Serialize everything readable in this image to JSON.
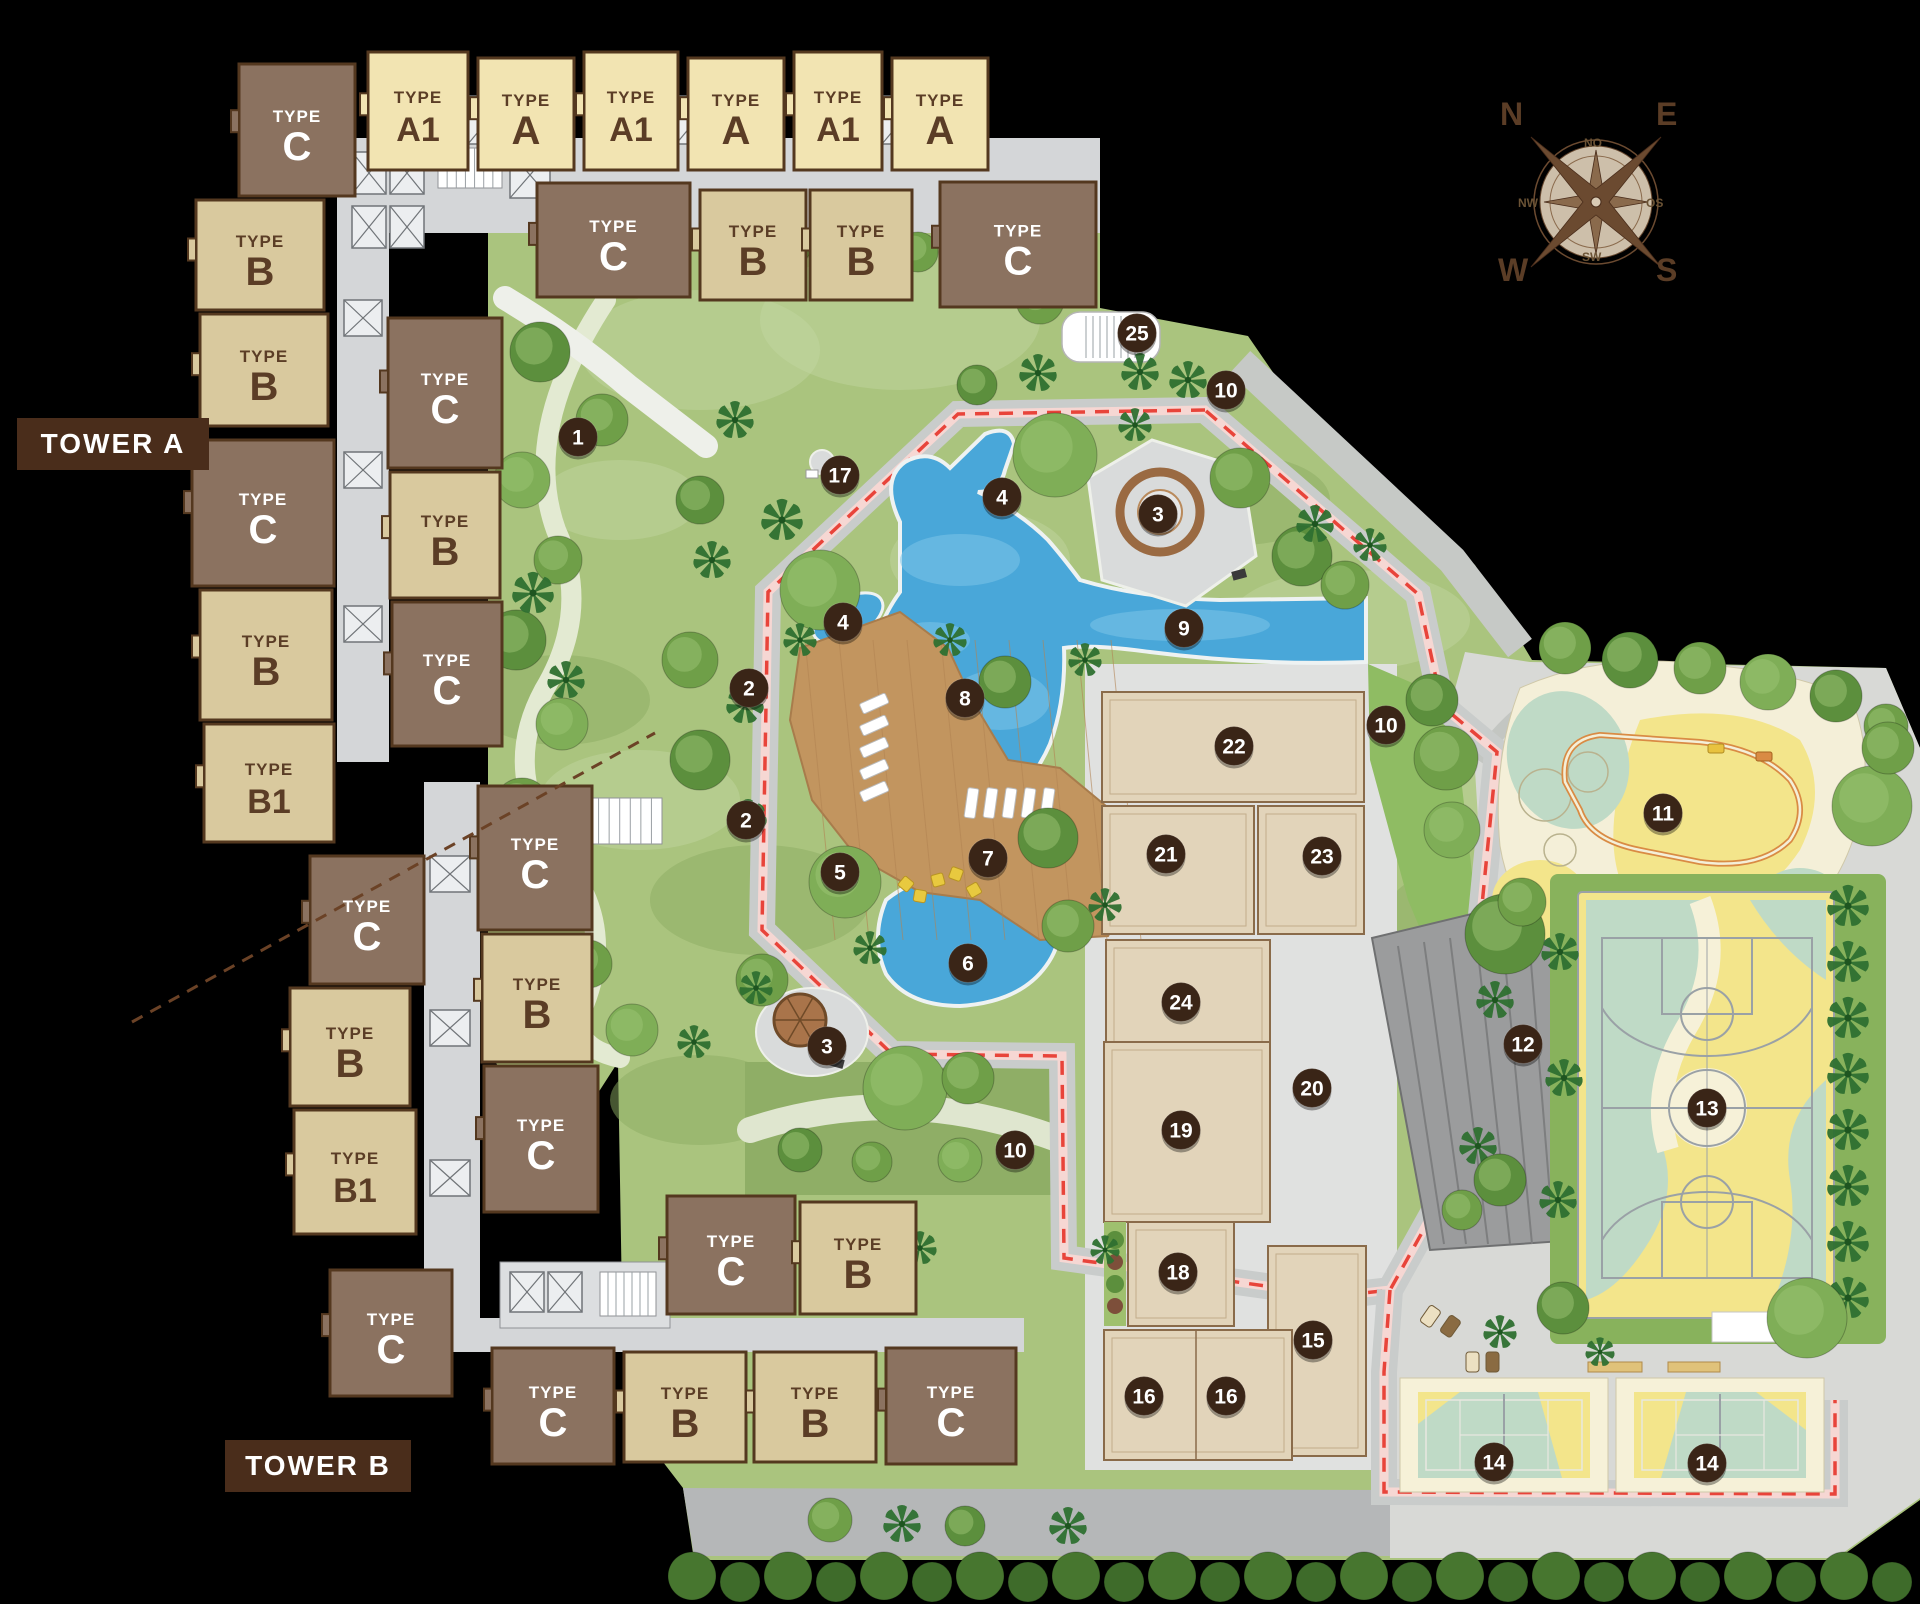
{
  "labels": {
    "tower_a": "TOWER A",
    "tower_b": "TOWER B",
    "type_word": "TYPE"
  },
  "compass": {
    "north": "N",
    "east": "E",
    "south": "S",
    "west": "W",
    "inner": [
      "NO",
      "OS",
      "SW",
      "NW"
    ]
  },
  "colors": {
    "marker_bg": "#3a2517",
    "marker_text": "#ffffff",
    "brown_building": "#8b7260",
    "tan_building": "#d9c99e",
    "cream_building": "#f2e4b2",
    "building_outline": "#54381f",
    "building_text_dark": "#5b3d26",
    "building_text_light": "#ffffff",
    "tower_label_bg": "#4a2d1b",
    "track_red": "#e8443a",
    "pool_blue": "#49a7d9",
    "deck_wood": "#c2955f",
    "grass": "#aac47e",
    "plaza_gray": "#e0e1e0"
  },
  "buildings": [
    {
      "label": "C",
      "style": "brown",
      "x": 239,
      "y": 64,
      "w": 116,
      "h": 132
    },
    {
      "label": "A1",
      "style": "cream",
      "x": 368,
      "y": 52,
      "w": 100,
      "h": 118
    },
    {
      "label": "A",
      "style": "cream",
      "x": 478,
      "y": 58,
      "w": 96,
      "h": 112
    },
    {
      "label": "A1",
      "style": "cream",
      "x": 584,
      "y": 52,
      "w": 94,
      "h": 118
    },
    {
      "label": "A",
      "style": "cream",
      "x": 688,
      "y": 58,
      "w": 96,
      "h": 112
    },
    {
      "label": "A1",
      "style": "cream",
      "x": 794,
      "y": 52,
      "w": 88,
      "h": 118
    },
    {
      "label": "A",
      "style": "cream",
      "x": 892,
      "y": 58,
      "w": 96,
      "h": 112
    },
    {
      "label": "C",
      "style": "brown",
      "x": 537,
      "y": 183,
      "w": 153,
      "h": 114
    },
    {
      "label": "B",
      "style": "tan",
      "x": 700,
      "y": 190,
      "w": 106,
      "h": 110
    },
    {
      "label": "B",
      "style": "tan",
      "x": 810,
      "y": 190,
      "w": 102,
      "h": 110
    },
    {
      "label": "C",
      "style": "brown",
      "x": 940,
      "y": 182,
      "w": 156,
      "h": 125
    },
    {
      "label": "B",
      "style": "tan",
      "x": 196,
      "y": 200,
      "w": 128,
      "h": 110
    },
    {
      "label": "B",
      "style": "tan",
      "x": 200,
      "y": 314,
      "w": 128,
      "h": 112
    },
    {
      "label": "C",
      "style": "brown",
      "x": 192,
      "y": 440,
      "w": 142,
      "h": 146
    },
    {
      "label": "B",
      "style": "tan",
      "x": 200,
      "y": 590,
      "w": 132,
      "h": 130
    },
    {
      "label": "B1",
      "style": "tan",
      "x": 204,
      "y": 724,
      "w": 130,
      "h": 118
    },
    {
      "label": "C",
      "style": "brown",
      "x": 388,
      "y": 318,
      "w": 114,
      "h": 150
    },
    {
      "label": "B",
      "style": "tan",
      "x": 390,
      "y": 472,
      "w": 110,
      "h": 126
    },
    {
      "label": "C",
      "style": "brown",
      "x": 392,
      "y": 602,
      "w": 110,
      "h": 144
    },
    {
      "label": "C",
      "style": "brown",
      "x": 310,
      "y": 856,
      "w": 114,
      "h": 128
    },
    {
      "label": "B",
      "style": "tan",
      "x": 290,
      "y": 988,
      "w": 120,
      "h": 118
    },
    {
      "label": "B1",
      "style": "tan",
      "x": 294,
      "y": 1110,
      "w": 122,
      "h": 124
    },
    {
      "label": "C",
      "style": "brown",
      "x": 330,
      "y": 1270,
      "w": 122,
      "h": 126
    },
    {
      "label": "C",
      "style": "brown",
      "x": 478,
      "y": 786,
      "w": 114,
      "h": 144
    },
    {
      "label": "B",
      "style": "tan",
      "x": 482,
      "y": 934,
      "w": 110,
      "h": 128
    },
    {
      "label": "C",
      "style": "brown",
      "x": 484,
      "y": 1066,
      "w": 114,
      "h": 146
    },
    {
      "label": "C",
      "style": "brown",
      "x": 667,
      "y": 1196,
      "w": 128,
      "h": 118
    },
    {
      "label": "B",
      "style": "tan",
      "x": 800,
      "y": 1202,
      "w": 116,
      "h": 112
    },
    {
      "label": "C",
      "style": "brown",
      "x": 492,
      "y": 1348,
      "w": 122,
      "h": 116
    },
    {
      "label": "B",
      "style": "tan",
      "x": 624,
      "y": 1352,
      "w": 122,
      "h": 110
    },
    {
      "label": "B",
      "style": "tan",
      "x": 754,
      "y": 1352,
      "w": 122,
      "h": 110
    },
    {
      "label": "C",
      "style": "brown",
      "x": 886,
      "y": 1348,
      "w": 130,
      "h": 116
    }
  ],
  "markers": [
    {
      "n": "1",
      "x": 578,
      "y": 437
    },
    {
      "n": "2",
      "x": 749,
      "y": 688
    },
    {
      "n": "2",
      "x": 746,
      "y": 820
    },
    {
      "n": "3",
      "x": 1158,
      "y": 514
    },
    {
      "n": "3",
      "x": 827,
      "y": 1046
    },
    {
      "n": "4",
      "x": 1002,
      "y": 497
    },
    {
      "n": "4",
      "x": 843,
      "y": 622
    },
    {
      "n": "5",
      "x": 840,
      "y": 872
    },
    {
      "n": "6",
      "x": 968,
      "y": 963
    },
    {
      "n": "7",
      "x": 988,
      "y": 858
    },
    {
      "n": "8",
      "x": 965,
      "y": 698
    },
    {
      "n": "9",
      "x": 1184,
      "y": 628
    },
    {
      "n": "10",
      "x": 1226,
      "y": 390
    },
    {
      "n": "10",
      "x": 1386,
      "y": 725
    },
    {
      "n": "10",
      "x": 1015,
      "y": 1150
    },
    {
      "n": "11",
      "x": 1663,
      "y": 813
    },
    {
      "n": "12",
      "x": 1523,
      "y": 1044
    },
    {
      "n": "13",
      "x": 1707,
      "y": 1108
    },
    {
      "n": "14",
      "x": 1494,
      "y": 1462
    },
    {
      "n": "14",
      "x": 1707,
      "y": 1463
    },
    {
      "n": "15",
      "x": 1313,
      "y": 1340
    },
    {
      "n": "16",
      "x": 1144,
      "y": 1396
    },
    {
      "n": "16",
      "x": 1226,
      "y": 1396
    },
    {
      "n": "17",
      "x": 840,
      "y": 475
    },
    {
      "n": "18",
      "x": 1178,
      "y": 1272
    },
    {
      "n": "19",
      "x": 1181,
      "y": 1130
    },
    {
      "n": "20",
      "x": 1312,
      "y": 1088
    },
    {
      "n": "21",
      "x": 1166,
      "y": 854
    },
    {
      "n": "22",
      "x": 1234,
      "y": 746
    },
    {
      "n": "23",
      "x": 1322,
      "y": 856
    },
    {
      "n": "24",
      "x": 1181,
      "y": 1002
    },
    {
      "n": "25",
      "x": 1137,
      "y": 333
    }
  ]
}
